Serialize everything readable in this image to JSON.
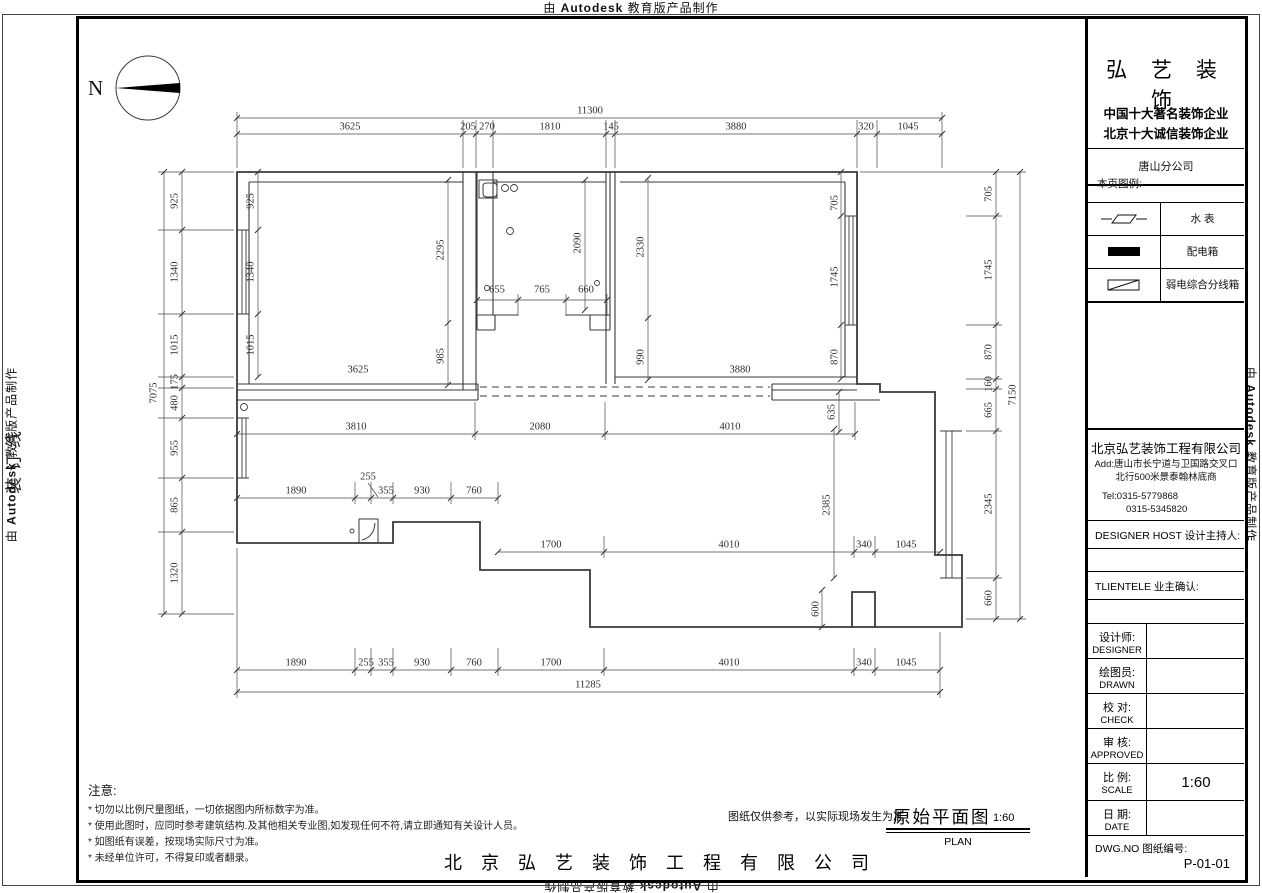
{
  "watermark": {
    "p1": "由 ",
    "p2": "Autodesk",
    "p3": " 教育版产品制作"
  },
  "binding_line": "装订线",
  "north": {
    "label": "N"
  },
  "title_block": {
    "brand": "弘 艺 装 饰",
    "slogan1": "中国十大著名装饰企业",
    "slogan2": "北京十大诚信装饰企业",
    "branch": "唐山分公司",
    "legend_title": "本页图例:",
    "legend": [
      {
        "icon": "water-meter-symbol",
        "label": "水  表"
      },
      {
        "icon": "distribution-box-symbol",
        "label": "配电箱"
      },
      {
        "icon": "weak-current-box-symbol",
        "label": "弱电综合分线箱"
      }
    ],
    "company": "北京弘艺装饰工程有限公司",
    "address1": "Add:唐山市长宁道与卫国路交叉口",
    "address2": "北行500米景泰翰林底商",
    "tel1": "Tel:0315-5779868",
    "tel2": "0315-5345820",
    "designer_host": "DESIGNER HOST   设计主持人:",
    "clientele": "TLIENTELE   业主确认:",
    "rows": [
      {
        "cn": "设计师:",
        "en": "DESIGNER"
      },
      {
        "cn": "绘图员:",
        "en": "DRAWN"
      },
      {
        "cn": "校  对:",
        "en": "CHECK"
      },
      {
        "cn": "审  核:",
        "en": "APPROVED"
      },
      {
        "cn": "比  例:",
        "en": "SCALE"
      },
      {
        "cn": "日  期:",
        "en": "DATE"
      }
    ],
    "scale_value": "1:60",
    "dwg_label": "DWG.NO   图纸编号:",
    "dwg_no": "P-01-01"
  },
  "notes": {
    "title": "注意:",
    "items": [
      "* 切勿以比例尺量图纸，一切依据图内所标数字为准。",
      "* 使用此图时，应同时参考建筑结构.及其他相关专业图,如发现任何不符,请立即通知有关设计人员。",
      "* 如图纸有误差，按现场实际尺寸为准。",
      "* 未经单位许可，不得复印或者翻录。"
    ]
  },
  "footer": {
    "disclaimer": "图纸仅供参考，以实际现场发生为准",
    "drawing_title": "原始平面图",
    "drawing_scale": "1:60",
    "drawing_subtitle": "PLAN",
    "company": "北 京 弘 艺 装 饰 工 程 有 限 公 司"
  },
  "plan": {
    "overall": {
      "top": "11300",
      "bottom": "11285",
      "left": "7075",
      "right": "7150"
    },
    "dim_labels": [
      {
        "t": "11300",
        "x": 590,
        "y": 111,
        "r": 0
      },
      {
        "t": "3625",
        "x": 350,
        "y": 127,
        "r": 0
      },
      {
        "t": "205",
        "x": 468,
        "y": 127,
        "r": 0
      },
      {
        "t": "270",
        "x": 487,
        "y": 127,
        "r": 0
      },
      {
        "t": "1810",
        "x": 550,
        "y": 127,
        "r": 0
      },
      {
        "t": "145",
        "x": 611,
        "y": 127,
        "r": 0
      },
      {
        "t": "3880",
        "x": 736,
        "y": 127,
        "r": 0
      },
      {
        "t": "320",
        "x": 866,
        "y": 127,
        "r": 0
      },
      {
        "t": "1045",
        "x": 908,
        "y": 127,
        "r": 0
      },
      {
        "t": "1890",
        "x": 296,
        "y": 663,
        "r": 0
      },
      {
        "t": "255",
        "x": 366,
        "y": 663,
        "r": 0
      },
      {
        "t": "355",
        "x": 386,
        "y": 663,
        "r": 0
      },
      {
        "t": "930",
        "x": 422,
        "y": 663,
        "r": 0
      },
      {
        "t": "760",
        "x": 474,
        "y": 663,
        "r": 0
      },
      {
        "t": "1700",
        "x": 551,
        "y": 663,
        "r": 0
      },
      {
        "t": "4010",
        "x": 729,
        "y": 663,
        "r": 0
      },
      {
        "t": "340",
        "x": 864,
        "y": 663,
        "r": 0
      },
      {
        "t": "1045",
        "x": 906,
        "y": 663,
        "r": 0
      },
      {
        "t": "11285",
        "x": 588,
        "y": 685,
        "r": 0
      },
      {
        "t": "7075",
        "x": 154,
        "y": 393,
        "r": 1
      },
      {
        "t": "925",
        "x": 175,
        "y": 201,
        "r": 1
      },
      {
        "t": "1340",
        "x": 175,
        "y": 272,
        "r": 1
      },
      {
        "t": "1015",
        "x": 175,
        "y": 345,
        "r": 1
      },
      {
        "t": "175",
        "x": 175,
        "y": 382,
        "r": 1
      },
      {
        "t": "480",
        "x": 175,
        "y": 403,
        "r": 1
      },
      {
        "t": "955",
        "x": 175,
        "y": 448,
        "r": 1
      },
      {
        "t": "865",
        "x": 175,
        "y": 505,
        "r": 1
      },
      {
        "t": "1320",
        "x": 175,
        "y": 573,
        "r": 1
      },
      {
        "t": "925",
        "x": 251,
        "y": 201,
        "r": 1
      },
      {
        "t": "1340",
        "x": 251,
        "y": 272,
        "r": 1
      },
      {
        "t": "1015",
        "x": 251,
        "y": 345,
        "r": 1
      },
      {
        "t": "7150",
        "x": 1013,
        "y": 395,
        "r": 1
      },
      {
        "t": "705",
        "x": 989,
        "y": 194,
        "r": 1
      },
      {
        "t": "1745",
        "x": 989,
        "y": 270,
        "r": 1
      },
      {
        "t": "870",
        "x": 989,
        "y": 352,
        "r": 1
      },
      {
        "t": "160",
        "x": 989,
        "y": 384,
        "r": 1
      },
      {
        "t": "665",
        "x": 989,
        "y": 410,
        "r": 1
      },
      {
        "t": "2345",
        "x": 989,
        "y": 504,
        "r": 1
      },
      {
        "t": "660",
        "x": 989,
        "y": 598,
        "r": 1
      },
      {
        "t": "705",
        "x": 835,
        "y": 203,
        "r": 1
      },
      {
        "t": "1745",
        "x": 835,
        "y": 277,
        "r": 1
      },
      {
        "t": "870",
        "x": 835,
        "y": 357,
        "r": 1
      },
      {
        "t": "2295",
        "x": 441,
        "y": 250,
        "r": 1
      },
      {
        "t": "985",
        "x": 441,
        "y": 356,
        "r": 1
      },
      {
        "t": "3625",
        "x": 358,
        "y": 370,
        "r": 0
      },
      {
        "t": "2330",
        "x": 641,
        "y": 247,
        "r": 1
      },
      {
        "t": "990",
        "x": 641,
        "y": 357,
        "r": 1
      },
      {
        "t": "3880",
        "x": 740,
        "y": 370,
        "r": 0
      },
      {
        "t": "655",
        "x": 497,
        "y": 290,
        "r": 0
      },
      {
        "t": "765",
        "x": 542,
        "y": 290,
        "r": 0
      },
      {
        "t": "660",
        "x": 586,
        "y": 290,
        "r": 0
      },
      {
        "t": "2090",
        "x": 578,
        "y": 243,
        "r": 1
      },
      {
        "t": "3810",
        "x": 356,
        "y": 427,
        "r": 0
      },
      {
        "t": "2080",
        "x": 540,
        "y": 427,
        "r": 0
      },
      {
        "t": "4010",
        "x": 730,
        "y": 427,
        "r": 0
      },
      {
        "t": "635",
        "x": 832,
        "y": 412,
        "r": 1
      },
      {
        "t": "1890",
        "x": 296,
        "y": 491,
        "r": 0
      },
      {
        "t": "255",
        "x": 368,
        "y": 477,
        "r": 0
      },
      {
        "t": "355",
        "x": 386,
        "y": 491,
        "r": 0
      },
      {
        "t": "930",
        "x": 422,
        "y": 491,
        "r": 0
      },
      {
        "t": "760",
        "x": 474,
        "y": 491,
        "r": 0
      },
      {
        "t": "1700",
        "x": 551,
        "y": 545,
        "r": 0
      },
      {
        "t": "4010",
        "x": 729,
        "y": 545,
        "r": 0
      },
      {
        "t": "340",
        "x": 864,
        "y": 545,
        "r": 0
      },
      {
        "t": "1045",
        "x": 906,
        "y": 545,
        "r": 0
      },
      {
        "t": "2385",
        "x": 827,
        "y": 505,
        "r": 1
      },
      {
        "t": "600",
        "x": 816,
        "y": 609,
        "r": 1
      }
    ]
  }
}
